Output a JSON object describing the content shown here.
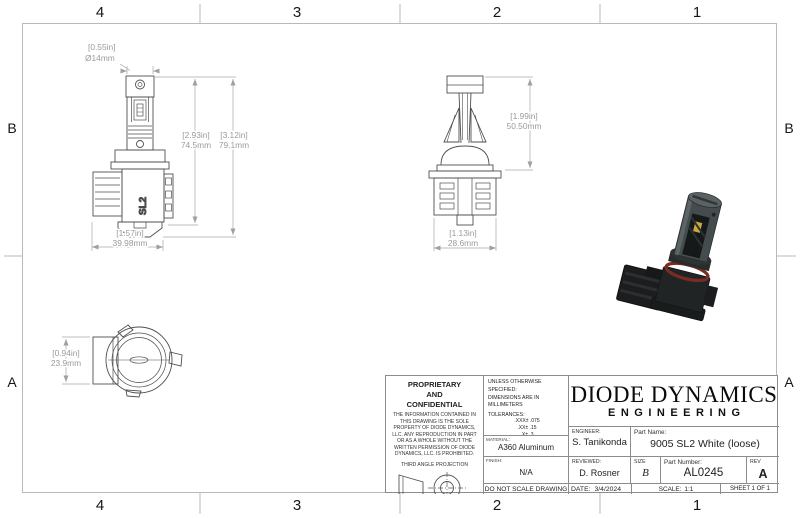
{
  "zones": {
    "top": [
      "4",
      "3",
      "2",
      "1"
    ],
    "bottom": [
      "4",
      "3",
      "2",
      "1"
    ],
    "left": [
      "B",
      "A"
    ],
    "right": [
      "B",
      "A"
    ]
  },
  "dims": {
    "front_dia": [
      "[0.55in]",
      "Ø14mm"
    ],
    "front_h1": [
      "[2.93in]",
      "74.5mm"
    ],
    "front_h2": [
      "[3.12in]",
      "79.1mm"
    ],
    "front_w": [
      "[1.57in]",
      "39.98mm"
    ],
    "side_h": [
      "[1.99in]",
      "50.50mm"
    ],
    "side_w": [
      "[1.13in]",
      "28.6mm"
    ],
    "top_h": [
      "[0.94in]",
      "23.9mm"
    ]
  },
  "views": {
    "front": {
      "logo": "SL2"
    }
  },
  "title_block": {
    "proprietary": {
      "heading_l1": "PROPRIETARY",
      "heading_l2": "AND",
      "heading_l3": "CONFIDENTIAL",
      "body": "THE INFORMATION CONTAINED IN THIS DRAWING IS THE SOLE PROPERTY OF DIODE DYNAMICS, LLC.  ANY REPRODUCTION IN PART OR AS A WHOLE WITHOUT THE WRITTEN PERMISSION OF DIODE DYNAMICS, LLC. IS PROHIBITED.",
      "projection_label": "THIRD ANGLE PROJECTION"
    },
    "specs": {
      "line1": "UNLESS OTHERWISE SPECIFIED:",
      "line2": "DIMENSIONS ARE IN MILLIMETERS",
      "tolerances_label": "TOLERANCES:",
      "tolerances": [
        ".XXX± .075",
        ".XX± .15",
        ".X± .3",
        "± .5",
        "ANG± 1"
      ],
      "material_label": "MATERIAL:",
      "material": "A360 Aluminum",
      "finish_label": "FINISH:",
      "finish": "N/A",
      "no_scale": "DO NOT SCALE DRAWING"
    },
    "company": {
      "name": "DIODE DYNAMICS",
      "division": "ENGINEERING"
    },
    "fields": {
      "engineer_label": "ENGINEER:",
      "engineer": "S. Tanikonda",
      "part_name_label": "Part Name:",
      "part_name": "9005 SL2 White (loose)",
      "reviewed_label": "REVIEWED:",
      "reviewed": "D. Rosner",
      "size_label": "SIZE",
      "size": "B",
      "part_number_label": "Part Number:",
      "part_number": "AL0245",
      "rev_label": "REV",
      "rev": "A",
      "date_label": "DATE:",
      "date": "3/4/2024",
      "scale_label": "SCALE:",
      "scale_value": "1:1",
      "sheet": "SHEET 1 OF 1"
    }
  },
  "colors": {
    "frame_line": "#b9b9b9",
    "drawing_line": "#4f4f4f",
    "dimension": "#9b9b9b",
    "title_block_line": "#8c8c8c",
    "render_body": "#454c4d",
    "render_dark": "#1b1d1e",
    "render_ring": "#7d2a24",
    "render_chip": "#caa83d"
  }
}
